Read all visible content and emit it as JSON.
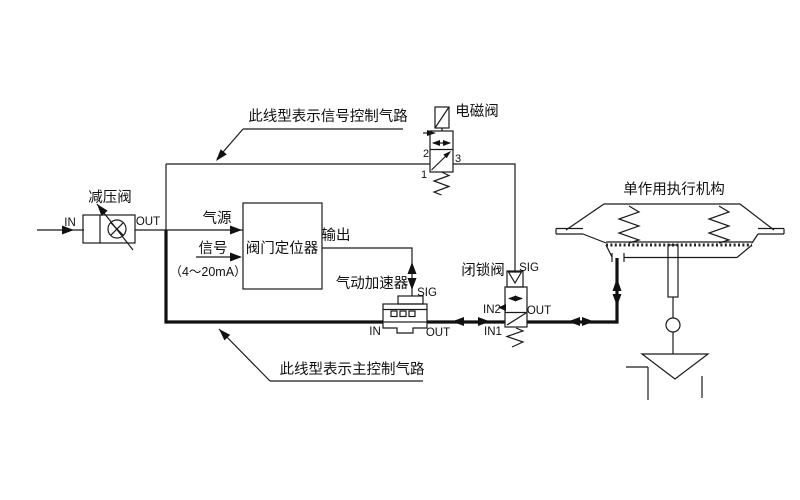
{
  "colors": {
    "background": "#ffffff",
    "line": "#1a1a1a"
  },
  "components": {
    "reducing_valve": {
      "label": "减压阀",
      "in": "IN",
      "out": "OUT"
    },
    "positioner": {
      "label": "阀门定位器",
      "air_source": "气源",
      "signal": "信号",
      "signal_range": "（4～20mA）",
      "output": "输出"
    },
    "booster": {
      "label": "气动加速器",
      "sig": "SIG",
      "in": "IN",
      "out": "OUT"
    },
    "solenoid_valve": {
      "label": "电磁阀",
      "port1": "1",
      "port2": "2",
      "port3": "3"
    },
    "lockup_valve": {
      "label": "闭锁阀",
      "sig": "SIG",
      "in2": "IN2",
      "out": "OUT",
      "in1": "IN1"
    },
    "actuator": {
      "label": "单作用执行机构"
    }
  },
  "notes": {
    "signal_line": "此线型表示信号控制气路",
    "main_line": "此线型表示主控制气路"
  }
}
